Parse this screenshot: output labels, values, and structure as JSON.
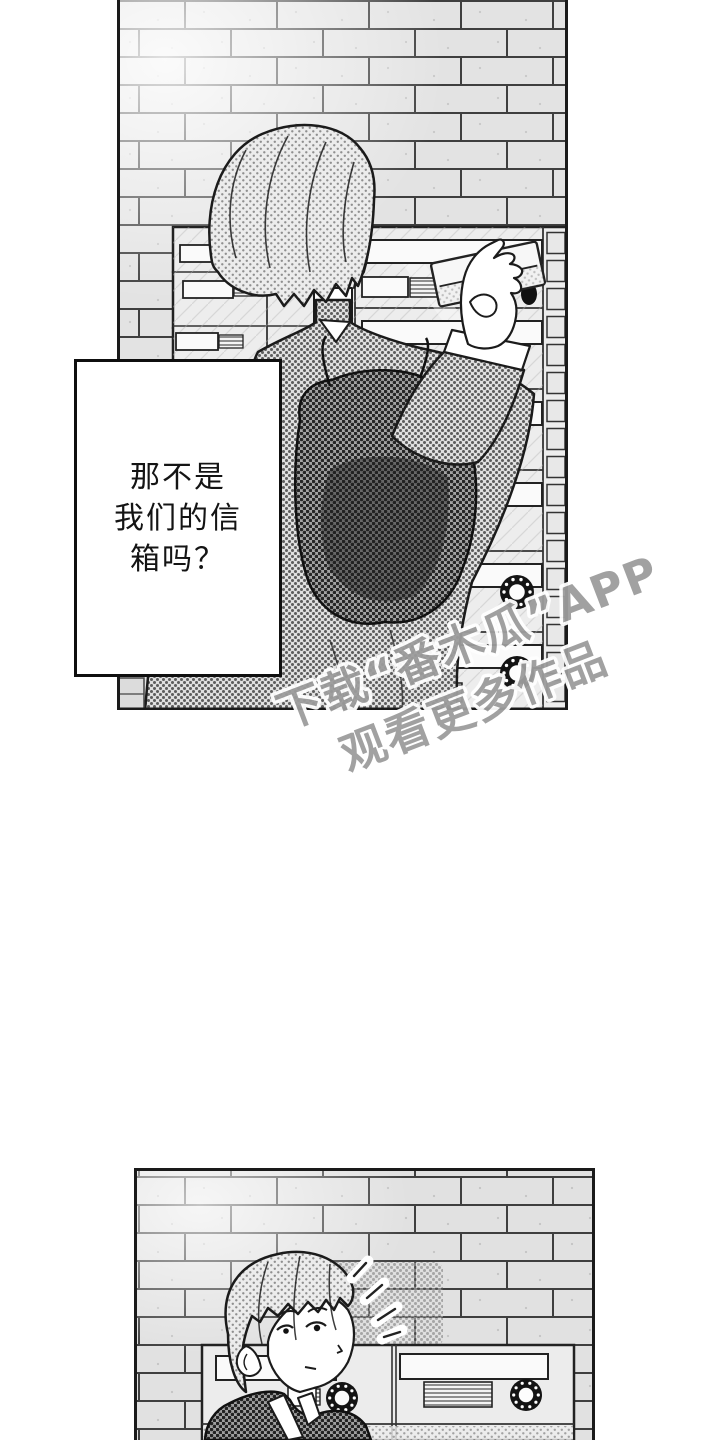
{
  "page": {
    "width": 720,
    "height": 1440,
    "background": "#ffffff"
  },
  "comic": {
    "panel1": {
      "description": "Back view of a short-haired person with a dark backpack standing at a bank of apartment mailboxes on a brick wall, sliding an envelope into a slot"
    },
    "panel2": {
      "description": "Same person in front of the mailboxes glancing back over their shoulder, startled, with notice marks beside their head"
    }
  },
  "speech": {
    "lines": [
      "那不是",
      "我们的信",
      "箱吗？"
    ],
    "full_text": "那不是我们的信箱吗？"
  },
  "watermark": {
    "line1": "下载“番木瓜”APP",
    "line2": "观看更多作品",
    "color": "#9c9c9c",
    "outline_color": "#ffffff"
  },
  "colors": {
    "ink": "#1b1b1b",
    "brick_fill": "#e3e3e3",
    "paper": "#ffffff",
    "halftone": "#8f8f8f"
  }
}
